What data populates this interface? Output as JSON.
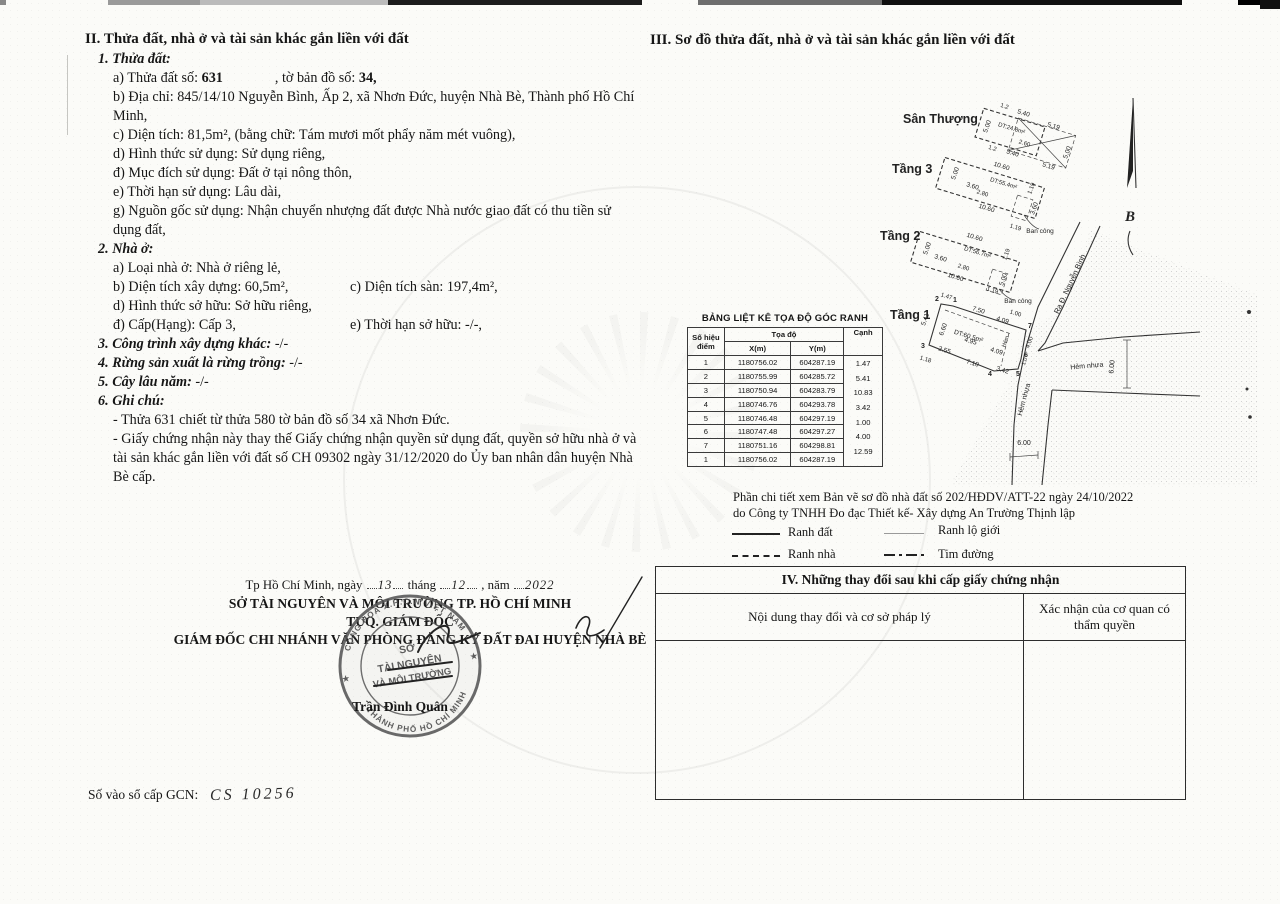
{
  "section_ii": {
    "title": "II. Thửa đất, nhà ở và tài sản khác gắn liền với đất",
    "parcel": {
      "heading": "1. Thửa đất:",
      "a_label": "a) Thửa đất số:",
      "a_number": "631",
      "a_mid": ", tờ bản đồ số:",
      "a_map": "34,",
      "b": "b) Địa chỉ: 845/14/10 Nguyễn Bình, Ấp 2, xã Nhơn Đức, huyện Nhà Bè, Thành phố Hồ Chí Minh,",
      "c": "c) Diện tích: 81,5m², (bằng chữ: Tám mươi mốt phẩy năm mét vuông),",
      "d": "d) Hình thức sử dụng: Sử dụng riêng,",
      "dd": "đ) Mục đích sử dụng: Đất ở tại nông thôn,",
      "e": "e) Thời hạn sử dụng: Lâu dài,",
      "g": "g) Nguồn gốc sử dụng: Nhận chuyển nhượng đất được Nhà nước giao đất có thu tiền sử dụng đất,"
    },
    "house": {
      "heading": "2. Nhà ở:",
      "a": "a) Loại nhà ở: Nhà ở riêng lẻ,",
      "b": "b) Diện tích xây dựng: 60,5m²,",
      "c": "c) Diện tích sàn: 197,4m²,",
      "d": "d) Hình thức sở hữu: Sở hữu riêng,",
      "dd": "đ) Cấp(Hạng): Cấp 3,",
      "e": "e) Thời hạn sở hữu: -/-,"
    },
    "item3_label": "3. Công trình xây dựng khác:",
    "item3_value": "-/-",
    "item4_label": "4. Rừng sản xuất là rừng trồng:",
    "item4_value": "-/-",
    "item5_label": "5. Cây lâu năm:",
    "item5_value": "-/-",
    "item6_label": "6. Ghi chú:",
    "note1": "- Thửa 631 chiết từ thửa 580 tờ bản đồ số 34 xã Nhơn Đức.",
    "note2": "- Giấy chứng nhận này thay thế Giấy chứng nhận quyền sử dụng đất, quyền sở hữu nhà ở và tài sản khác gắn liền với đất số CH 09302 ngày 31/12/2020 do Ủy ban nhân dân huyện Nhà Bè cấp."
  },
  "section_iii": {
    "title": "III. Sơ đồ thửa đất, nhà ở và tài sản khác gắn liền với đất",
    "plan": {
      "north_label": "B",
      "floors": [
        {
          "name": "Sân Thượng",
          "area": "DT:24.8m²",
          "dims": [
            "1.2",
            "5.40",
            "5.19",
            "5.00",
            "2.60",
            "1.2",
            "5.40",
            "5.19",
            "5.00"
          ]
        },
        {
          "name": "Tầng 3",
          "area": "DT:55.4m²",
          "balcony": "Ban công",
          "dims": [
            "10.60",
            "5.00",
            "3.60",
            "2.80",
            "1.19",
            "3.60",
            "10.60",
            "1.19"
          ]
        },
        {
          "name": "Tầng 2",
          "area": "DT:56.7m²",
          "balcony": "Ban công",
          "dims": [
            "10.60",
            "5.00",
            "3.60",
            "2.80",
            "1.19",
            "10.60",
            "5.00",
            "1.19"
          ]
        },
        {
          "name": "Tầng 1",
          "area": "DT:60.5m²",
          "hem": "Hẻm",
          "points": [
            "1",
            "2",
            "3",
            "4",
            "5",
            "6",
            "7"
          ],
          "dims": [
            "1.47",
            "7.50",
            "5.41",
            "6.60",
            "4.09",
            "1.00",
            "2.55",
            "4.95",
            "4.09",
            "7.10",
            "3.42",
            "1.18",
            "4.00",
            "1.0"
          ]
        }
      ],
      "roads": {
        "main": "Ra Đ. Nguyễn Bình",
        "alley_h": "Hẻm nhựa",
        "alley_v": "Hẻm nhựa",
        "width_1": "6.00",
        "width_2": "6.00"
      }
    },
    "coord_table": {
      "title": "BẢNG LIỆT KÊ TỌA ĐỘ GÓC RANH",
      "col_point": "Số hiệu điểm",
      "col_coord": "Tọa độ",
      "col_x": "X(m)",
      "col_y": "Y(m)",
      "col_edge": "Cạnh",
      "rows": [
        {
          "p": "1",
          "x": "1180756.02",
          "y": "604287.19"
        },
        {
          "p": "2",
          "x": "1180755.99",
          "y": "604285.72"
        },
        {
          "p": "3",
          "x": "1180750.94",
          "y": "604283.79"
        },
        {
          "p": "4",
          "x": "1180746.76",
          "y": "604293.78"
        },
        {
          "p": "5",
          "x": "1180746.48",
          "y": "604297.19"
        },
        {
          "p": "6",
          "x": "1180747.48",
          "y": "604297.27"
        },
        {
          "p": "7",
          "x": "1180751.16",
          "y": "604298.81"
        },
        {
          "p": "1",
          "x": "1180756.02",
          "y": "604287.19"
        }
      ],
      "edges": [
        "1.47",
        "5.41",
        "10.83",
        "3.42",
        "1.00",
        "4.00",
        "12.59"
      ]
    },
    "detail_note_1": "Phần chi tiết xem Bản vẽ sơ đồ nhà đất số 202/HĐDV/ATT-22 ngày 24/10/2022",
    "detail_note_2": "do Công ty TNHH Đo đạc Thiết kế- Xây dựng An Trường Thịnh lập",
    "legend": {
      "ranh_dat": "Ranh đất",
      "ranh_nha": "Ranh nhà",
      "ranh_lo_gioi": "Ranh lộ giới",
      "tim_duong": "Tim đường"
    }
  },
  "signature": {
    "place": "Tp Hồ Chí Minh, ngày",
    "day": "13",
    "thang": "tháng",
    "month": "12",
    "nam": ", năm",
    "year": "2022",
    "org": "SỞ TÀI NGUYÊN VÀ MÔI TRƯỜNG TP. HỒ CHÍ MINH",
    "title1": "TUQ. GIÁM ĐỐC",
    "title2": "GIÁM ĐỐC CHI NHÁNH VĂN PHÒNG ĐĂNG KÝ ĐẤT ĐAI HUYỆN NHÀ BÈ",
    "signer": "Trần Đình Quân",
    "stamp": {
      "ring_top": "CỘNG HÒA X.H.C.N VIỆT NAM",
      "ring_bottom": "THÀNH PHỐ HỒ CHÍ MINH",
      "line1": "SỞ",
      "line2": "TÀI NGUYÊN",
      "line3": "VÀ MÔI TRƯỜNG"
    }
  },
  "section_iv": {
    "title": "IV. Những thay đổi sau khi cấp giấy chứng nhận",
    "col_content": "Nội dung thay đổi và cơ sở pháp lý",
    "col_confirm": "Xác nhận của cơ quan có thẩm quyền"
  },
  "footer": {
    "serial_label": "Số vào sổ cấp GCN:",
    "serial_value": "CS 10256"
  }
}
